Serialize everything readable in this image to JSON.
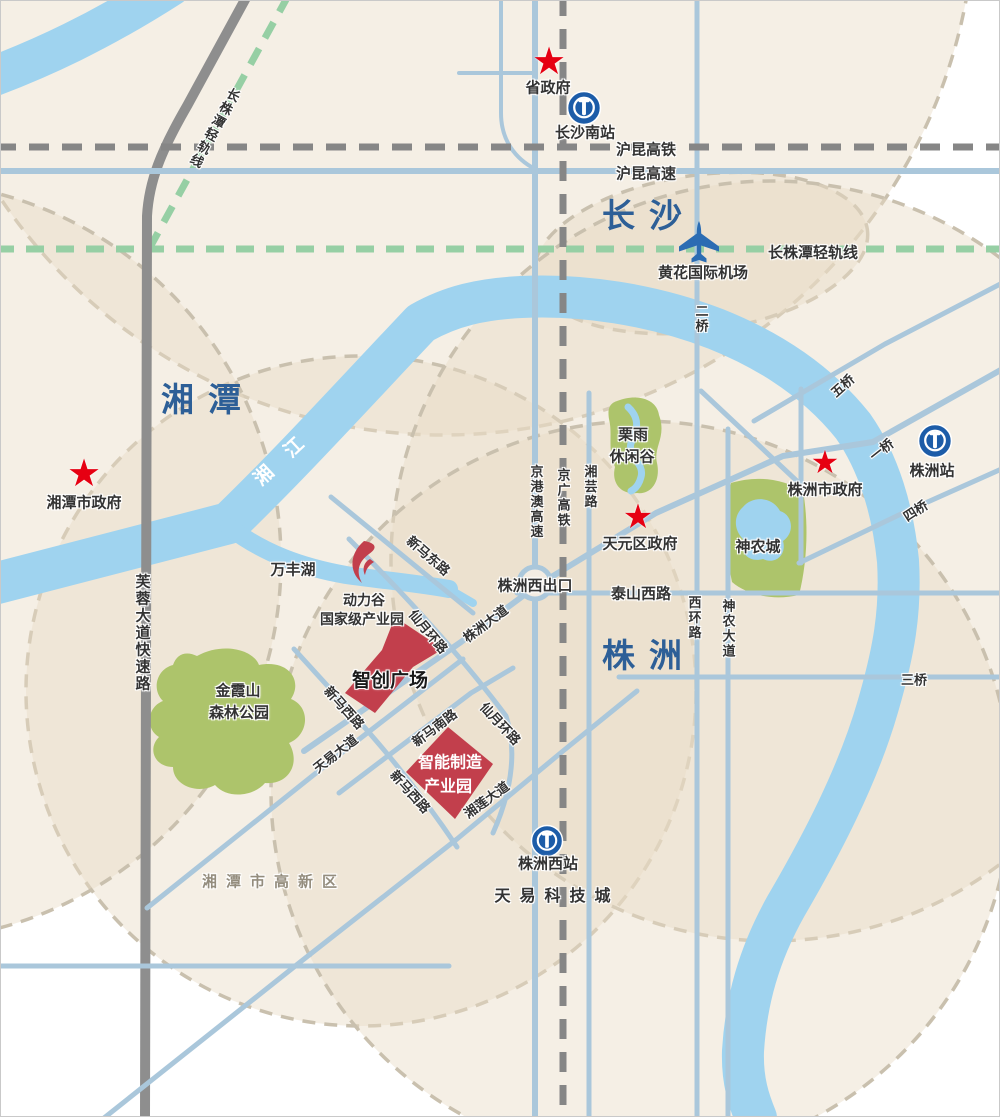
{
  "title": "长株潭区域位置示意图",
  "colors": {
    "river": "#9fd3ef",
    "road": "#aac7db",
    "rail_gray": "#868686",
    "light_rail_green": "#96cfa4",
    "park": "#adc46b",
    "zone_red": "#c23f4c",
    "star_red": "#e60012",
    "city_blue": "#2d5f97",
    "station_blue": "#1c5ca8",
    "zone_fill": "#e8dcc6"
  },
  "icons": {
    "star": "★"
  },
  "labels": {
    "sheng_zhengfu": "省政府",
    "changsha_nan_station": "长沙南站",
    "hukun_gaotie": "沪昆高铁",
    "hukun_gaosu": "沪昆高速",
    "changsha": "长沙",
    "czt_qinggui_right": "长株潭轻轨线",
    "czt_qinggui_left": "长株潭轻轨线",
    "huanghua_airport": "黄花国际机场",
    "er_qiao": "二桥",
    "xiangtan": "湘潭",
    "xiang_jiang": "湘江",
    "xiangtan_gov": "湘潭市政府",
    "wu_qiao": "五桥",
    "yi_qiao": "一桥",
    "si_qiao": "四桥",
    "san_qiao": "三桥",
    "zhuzhou_station": "株洲站",
    "zhuzhou_gov": "株洲市政府",
    "liyu_1": "栗雨",
    "liyu_2": "休闲谷",
    "xiangyun_lu": "湘芸路",
    "jinggangao_gaosu": "京港澳高速",
    "jingguang_gaotie": "京广高铁",
    "tianyuan_gov": "天元区政府",
    "shennong_cheng": "神农城",
    "taishan_xilu": "泰山西路",
    "xihuan_lu": "西环路",
    "shennong_dadao": "神农大道",
    "zhuzhou_xi_chukou": "株洲西出口",
    "wanfeng_hu": "万丰湖",
    "dongli_gu": "动力谷",
    "guojiaji_chanyeyuan": "国家级产业园",
    "xinma_donglu": "新马东路",
    "xianyue_huanlu_1": "仙月环路",
    "zhuzhou_dadao": "株洲大道",
    "zhichuang_guangchang": "智创广场",
    "jinxiashan_1": "金霞山",
    "jinxiashan_2": "森林公园",
    "xinma_xilu_1": "新马西路",
    "tianyi_dadao": "天易大道",
    "xinma_nanlu": "新马南路",
    "xianyue_huanlu_2": "仙月环路",
    "xinma_xilu_2": "新马西路",
    "zhineng_1": "智能制造",
    "zhineng_2": "产业园",
    "xianglian_dadao": "湘莲大道",
    "furong_dadao": "芙蓉大道快速路",
    "zhuzhou": "株洲",
    "zhuzhou_xi_station": "株洲西站",
    "tianyi_keji_cheng": "天易科技城",
    "xiangtan_gaoxin": "湘潭市高新区"
  }
}
